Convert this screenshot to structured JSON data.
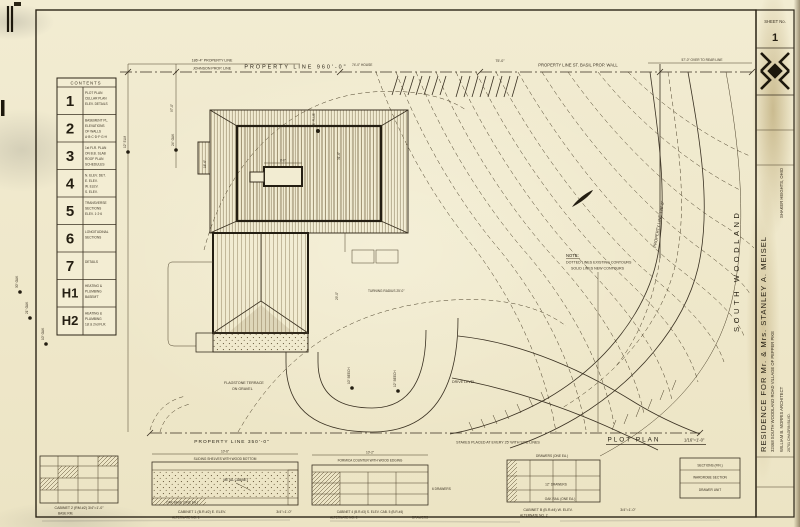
{
  "sheet": {
    "number_label": "SHEET No.",
    "number": "1"
  },
  "title_block": {
    "project": "RESIDENCE FOR Mr. & Mrs. STANLEY A. MEISEL",
    "address": "32468 SOUTH WOODLAND ROAD        VILLAGE OF PEPPER PIKE",
    "architect": "WILLIAM B. MORRIS      ARCHITECT",
    "architect_addr": "20701 CHAGRIN BLVD.",
    "architect_city": "SHAKER HEIGHTS, OHIO"
  },
  "contents": {
    "header": "CONTENTS",
    "rows": [
      {
        "num": "1",
        "l1": "PLOT PLAN",
        "l2": "CELLAR PLAN",
        "l3": "ELEV. DETAILS",
        "l4": ""
      },
      {
        "num": "2",
        "l1": "BASEMENT PL.",
        "l2": "ELEVATIONS",
        "l3": "OF WALLS",
        "l4": "A·B·C·D·F·G·H"
      },
      {
        "num": "3",
        "l1": "1st FLR. PLAN",
        "l2": "ON B.B. SLAB",
        "l3": "ROOF PLAN",
        "l4": "SCHEDULES"
      },
      {
        "num": "4",
        "l1": "N. ELEV. DET.",
        "l2": "E. ELEV.",
        "l3": "W. ELEV.",
        "l4": "S. ELEV."
      },
      {
        "num": "5",
        "l1": "TRANSVERSE",
        "l2": "SECTIONS",
        "l3": "ELEV. 1·2·6",
        "l4": ""
      },
      {
        "num": "6",
        "l1": "LONGITUDINAL",
        "l2": "SECTIONS",
        "l3": "",
        "l4": ""
      },
      {
        "num": "7",
        "l1": "DETAILS",
        "l2": "",
        "l3": "",
        "l4": ""
      },
      {
        "num": "H1",
        "l1": "HEATING &",
        "l2": "PLUMBING",
        "l3": "BASEM'T",
        "l4": ""
      },
      {
        "num": "H2",
        "l1": "HEATING &",
        "l2": "PLUMBING",
        "l3": "1st & 2nd FLR.",
        "l4": ""
      }
    ]
  },
  "property": {
    "top_small_dim": "186'-4\"  PROPERTY LINE",
    "top_owner": "JOHNSON PROP. LINE",
    "top_main": "PROPERTY LINE  960'-0\"",
    "top_house": "74'-0\" HOUSE",
    "top_right_dim": "75'-0\"",
    "top_right": "PROPERTY LINE   ST. BASIL PROP. WALL",
    "top_far_right": "57'-0\" OVER TO REAR LINE",
    "right_vert": "PROPERTY LINE 135'-0\"",
    "bottom": "PROPERTY LINE  350'-0\"",
    "stakes": "STAKES PLACED AT EVERY 25' WITH SITE LINES"
  },
  "plan": {
    "street": "SOUTH WOODLAND",
    "plot_plan": "PLOT PLAN",
    "scale": "1/16\"=1'-0\"",
    "note_title": "NOTE:",
    "note_line1": "DOTTED LINES EXISTING CONTOURS",
    "note_line2": "SOLID LINES NEW CONTOURS",
    "drive_level": "DRIVE LEVEL",
    "turning": "TURNING RADIUS 25'-0\"",
    "terrace1": "FLAGSTONE TERRACE",
    "terrace2": "ON GRAVEL",
    "flue": "38\" FLUE"
  },
  "dims": {
    "d97": "97'-0\"",
    "d31": "31'-6\"",
    "d29": "29'-0\"",
    "d8": "8'-0\"",
    "d16": "16'-6\""
  },
  "trees": {
    "t1": "30\" OAK",
    "t2": "21\" OAK",
    "t3": "10\" OAK",
    "t4": "12\" ELM",
    "t5": "24\" OAK",
    "t6": "10\" BEECH",
    "t7": "12\" BEECH"
  },
  "details": {
    "d1_caption": "CABINET 2 (RM.#2)  3/4\"=1'-0\"",
    "d1_sub": "BASE RM.",
    "d2_dim": "10'-6\"",
    "d2_note_top": "SLIDING SHELVES WITH WOOD BOTTOM",
    "d2_note_mid": "METAL CABINET",
    "d2_note_base": "OAK BASE (ONE EA.)",
    "d2_caption": "CABINET 1  (B.R.#2)   E. ELEV.",
    "d2_sub": "ALTERNATE NO. 1",
    "d2_scale": "3/4\"=1'-0\"",
    "d3_dim": "10'-2\"",
    "d3_note_top": "FORMICA COUNTER WITH WOOD EDGING",
    "d3_note_right": "6 DRAWERS",
    "d3_caption": "CABINET 4 (B.R.#3)  S. ELEV.   CAB. 5 (B.R.#4)",
    "d3_sub": "ALTERNATE NO. 2",
    "d3_sub2": "DRAWERS",
    "d4_note_top": "DRAWERS (ONE EA.)",
    "d4_note_mid": "12\" DRAWERS",
    "d4_note_base": "OAK RAIL (ONE EA.)",
    "d4_caption": "CABINET B (B.R.#4)  W. ELEV.",
    "d4_sub": "ALTERNATE NO. 2",
    "d4_scale": "3/4\"=1'-0\"",
    "d5_header": "SECTIONS (FIN.)",
    "d5_note1": "WARDROBE SECTION",
    "d5_note2": "DRAWER UNIT"
  },
  "colors": {
    "ink": "#3a3122",
    "ink_bold": "#241e12",
    "paper": "#f1ebcf"
  }
}
